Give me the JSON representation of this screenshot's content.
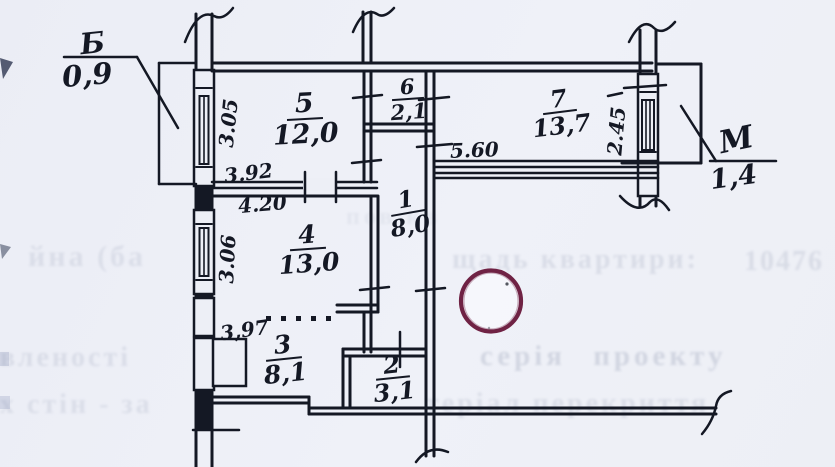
{
  "plan": {
    "rooms": {
      "r5": {
        "number": "5",
        "area": "12,0"
      },
      "r6": {
        "number": "6",
        "area": "2,1"
      },
      "r7": {
        "number": "7",
        "area": "13,7"
      },
      "r1": {
        "number": "1",
        "area": "8,0"
      },
      "r4": {
        "number": "4",
        "area": "13,0"
      },
      "r3": {
        "number": "3",
        "area": "8,1"
      },
      "r2": {
        "number": "2",
        "area": "3,1"
      }
    },
    "dims": {
      "d305": "3.05",
      "d392": "3.92",
      "d420": "4.20",
      "d306": "3.06",
      "d397": "3,97",
      "d560": "5.60",
      "d245": "2.45"
    },
    "points": {
      "b": {
        "letter": "Б",
        "value": "0,9"
      },
      "m": {
        "letter": "М",
        "value": "1,4"
      }
    }
  },
  "ghost": {
    "g0": "пов кв",
    "g1a": "йна (ба",
    "g1b": "щадь квартири:",
    "g1c": "10476",
    "g2a": "вленості",
    "g2b": "серія  проекту",
    "g3a": "х стін - за",
    "g3b": "теріал перекриття"
  },
  "colors": {
    "ink": "#141824",
    "paper": "#edeff6",
    "ghost": "#6c7795",
    "stamp": "#6f2244"
  }
}
